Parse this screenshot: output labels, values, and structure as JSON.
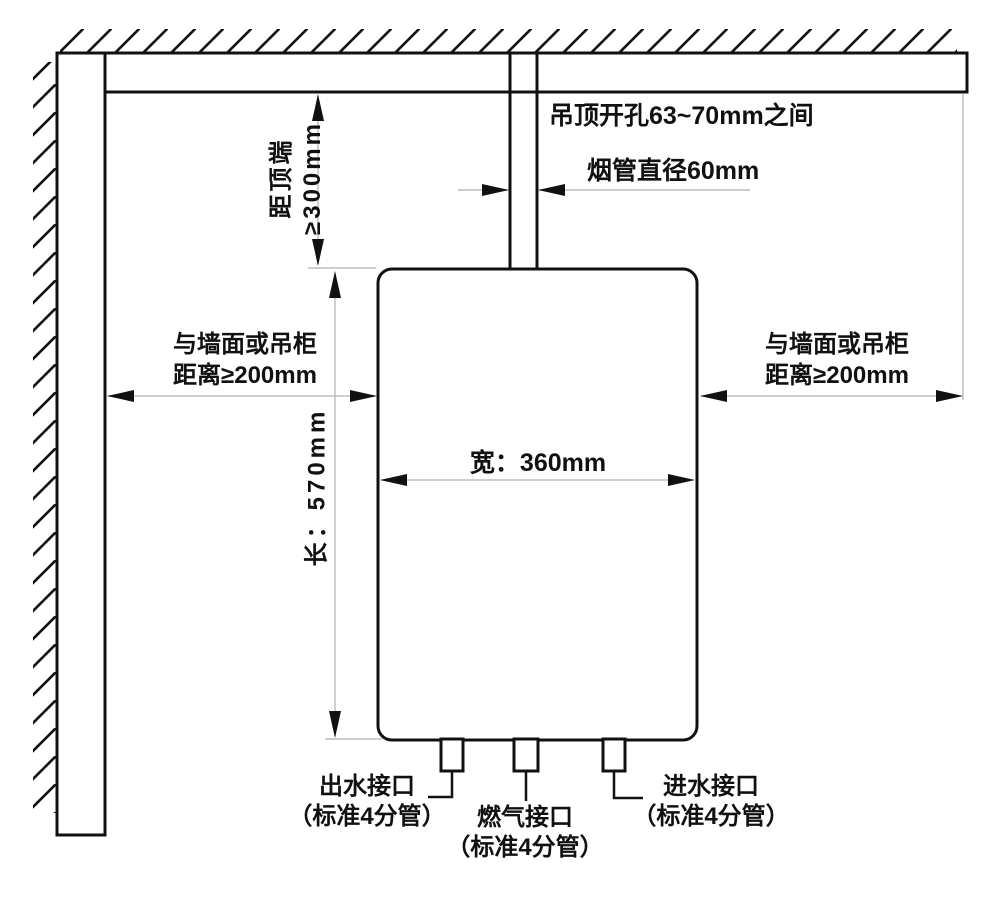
{
  "diagram": {
    "kind": "water-heater-installation-diagram",
    "annotations": {
      "ceiling_hole": "吊顶开孔63~70mm之间",
      "flue_diameter": "烟管直径60mm",
      "top_clearance": {
        "line1": "距顶端",
        "line2": "≥300mm"
      },
      "left_clearance": {
        "line1": "与墙面或吊柜",
        "line2": "距离≥200mm"
      },
      "right_clearance": {
        "line1": "与墙面或吊柜",
        "line2": "距离≥200mm"
      },
      "unit_height": "长：570mm",
      "unit_width": "宽：360mm",
      "water_outlet": {
        "line1": "出水接口",
        "line2": "（标准4分管）"
      },
      "gas_connection": {
        "line1": "燃气接口",
        "line2": "（标准4分管）"
      },
      "water_inlet": {
        "line1": "进水接口",
        "line2": "（标准4分管）"
      }
    },
    "colors": {
      "line": "#111111",
      "dimension_line": "#bdbdbd",
      "background": "#ffffff"
    }
  }
}
